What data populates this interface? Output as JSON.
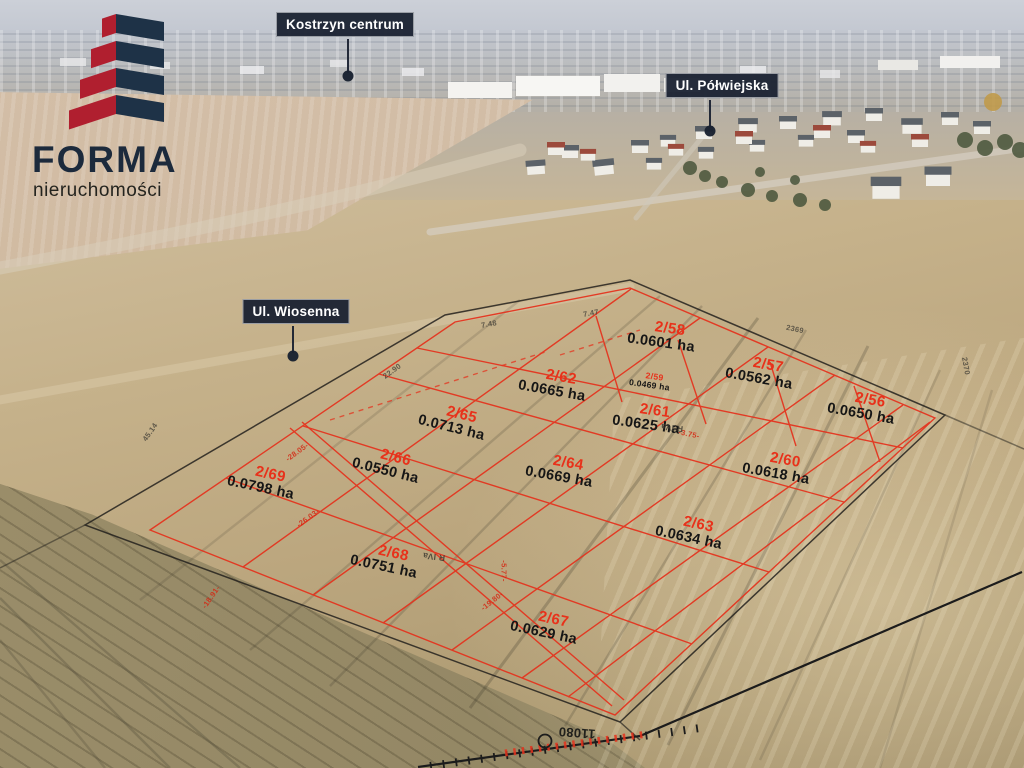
{
  "brand": {
    "name": "FORMA",
    "subtitle": "nieruchomości"
  },
  "map_pins": [
    {
      "label": "Kostrzyn centrum"
    },
    {
      "label": "Ul. Półwiejska"
    },
    {
      "label": "Ul. Wiosenna"
    }
  ],
  "plots": [
    {
      "number": "2/58",
      "area": "0.0601 ha"
    },
    {
      "number": "2/57",
      "area": "0.0562 ha"
    },
    {
      "number": "2/59",
      "area": "0.0469 ha"
    },
    {
      "number": "2/62",
      "area": "0.0665 ha"
    },
    {
      "number": "2/56",
      "area": "0.0650 ha"
    },
    {
      "number": "2/65",
      "area": "0.0713 ha"
    },
    {
      "number": "2/61",
      "area": "0.0625 ha"
    },
    {
      "number": "2/66",
      "area": "0.0550 ha"
    },
    {
      "number": "2/64",
      "area": "0.0669 ha"
    },
    {
      "number": "2/60",
      "area": "0.0618 ha"
    },
    {
      "number": "2/69",
      "area": "0.0798 ha"
    },
    {
      "number": "2/63",
      "area": "0.0634 ha"
    },
    {
      "number": "2/68",
      "area": "0.0751 ha"
    },
    {
      "number": "2/67",
      "area": "0.0629 ha"
    }
  ],
  "annotations": {
    "soil_class": "R IVa",
    "soil_class_2": "R IVa",
    "parcel_number_top": "2369",
    "parcel_number_right": "2370",
    "survey_point": "11080",
    "dimensions": [
      "-28.05-",
      "-26.03-",
      "-18.91-",
      "-19.80-",
      "-5.77-",
      "-3.75-",
      "22.90",
      "7.48",
      "7.47",
      "45.14"
    ]
  },
  "colors": {
    "boundary_red": "#e5311c",
    "pin_background": "#1d2433",
    "logo_red": "#b01f2f",
    "logo_navy": "#1e3247"
  }
}
